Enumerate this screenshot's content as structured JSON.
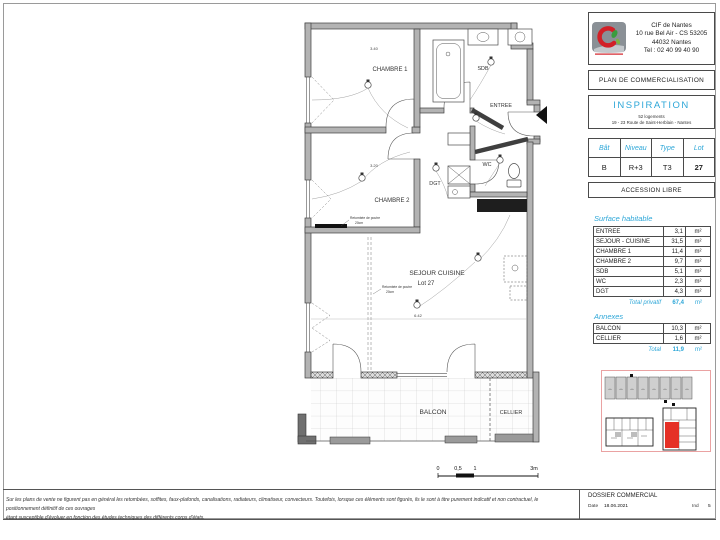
{
  "colors": {
    "accent_blue": "#2ea7d8",
    "highlight_red": "#e53026",
    "wall_gray": "#b3b3b3"
  },
  "plan": {
    "rooms": {
      "chambre1": "CHAMBRE 1",
      "sdb": "SDB",
      "entree": "ENTREE",
      "chambre2": "CHAMBRE 2",
      "dgt": "DGT",
      "wc": "WC",
      "sejour": "SEJOUR CUISINE",
      "lot": "Lot 27",
      "balcon": "BALCON",
      "cellier": "CELLIER"
    },
    "annotations": {
      "beam_label": "Retombée de poutre",
      "beam_size": "20cm",
      "dim_chambre1": "3.40",
      "dim_chambre2": "3.20",
      "dim_sejour": "6.42"
    },
    "scalebar": {
      "t0": "0",
      "t05": "0,5",
      "t1": "1",
      "t3": "3m"
    }
  },
  "panel": {
    "company": {
      "name": "CIF de Nantes",
      "address1": "10 rue Bel Air - CS 53205",
      "address2": "44032 Nantes",
      "tel": "Tel : 02 40 99 40 90"
    },
    "doc_type": "PLAN DE COMMERCIALISATION",
    "program": {
      "name": "INSPIRATION",
      "sub1": "52 logements",
      "sub2": "19 - 23 Route de Saint-Herblain - Nantes"
    },
    "lot_table": {
      "headers": [
        "Bât",
        "Niveau",
        "Type",
        "Lot"
      ],
      "values": [
        "B",
        "R+3",
        "T3",
        "27"
      ]
    },
    "accession": "ACCESSION LIBRE",
    "surface": {
      "title": "Surface habitable",
      "rows": [
        {
          "label": "ENTREE",
          "value": "3,1",
          "unit": "m²"
        },
        {
          "label": "SEJOUR - CUISINE",
          "value": "31,5",
          "unit": "m²"
        },
        {
          "label": "CHAMBRE 1",
          "value": "11,4",
          "unit": "m²"
        },
        {
          "label": "CHAMBRE 2",
          "value": "9,7",
          "unit": "m²"
        },
        {
          "label": "SDB",
          "value": "5,1",
          "unit": "m²"
        },
        {
          "label": "WC",
          "value": "2,3",
          "unit": "m²"
        },
        {
          "label": "DGT",
          "value": "4,3",
          "unit": "m²"
        }
      ],
      "total_label": "Total privatif",
      "total_value": "67,4",
      "total_unit": "m²"
    },
    "annexes": {
      "title": "Annexes",
      "rows": [
        {
          "label": "BALCON",
          "value": "10,3",
          "unit": "m²"
        },
        {
          "label": "CELLIER",
          "value": "1,6",
          "unit": "m²"
        }
      ],
      "total_label": "Total",
      "total_value": "11,9",
      "total_unit": "m²"
    }
  },
  "footer": {
    "disclaimer_line1": "Sur les plans de vente ne figurent pas en général les retombées, soffites, faux-plafonds, canalisations, radiateurs, climatiseur, convecteurs. Toutefois, lorsque ces éléments sont figurés, ils le sont à titre purement indicatif et non contractuel, le positionnement définitif de ces ouvrages",
    "disclaimer_line2": "étant susceptible d'évoluer en fonction des études techniques des différents corps d'états.",
    "dossier_title": "DOSSIER COMMERCIAL",
    "date_label": "Date",
    "date_value": "18.06.2021",
    "ind_label": "Ind",
    "ind_value": "5"
  }
}
